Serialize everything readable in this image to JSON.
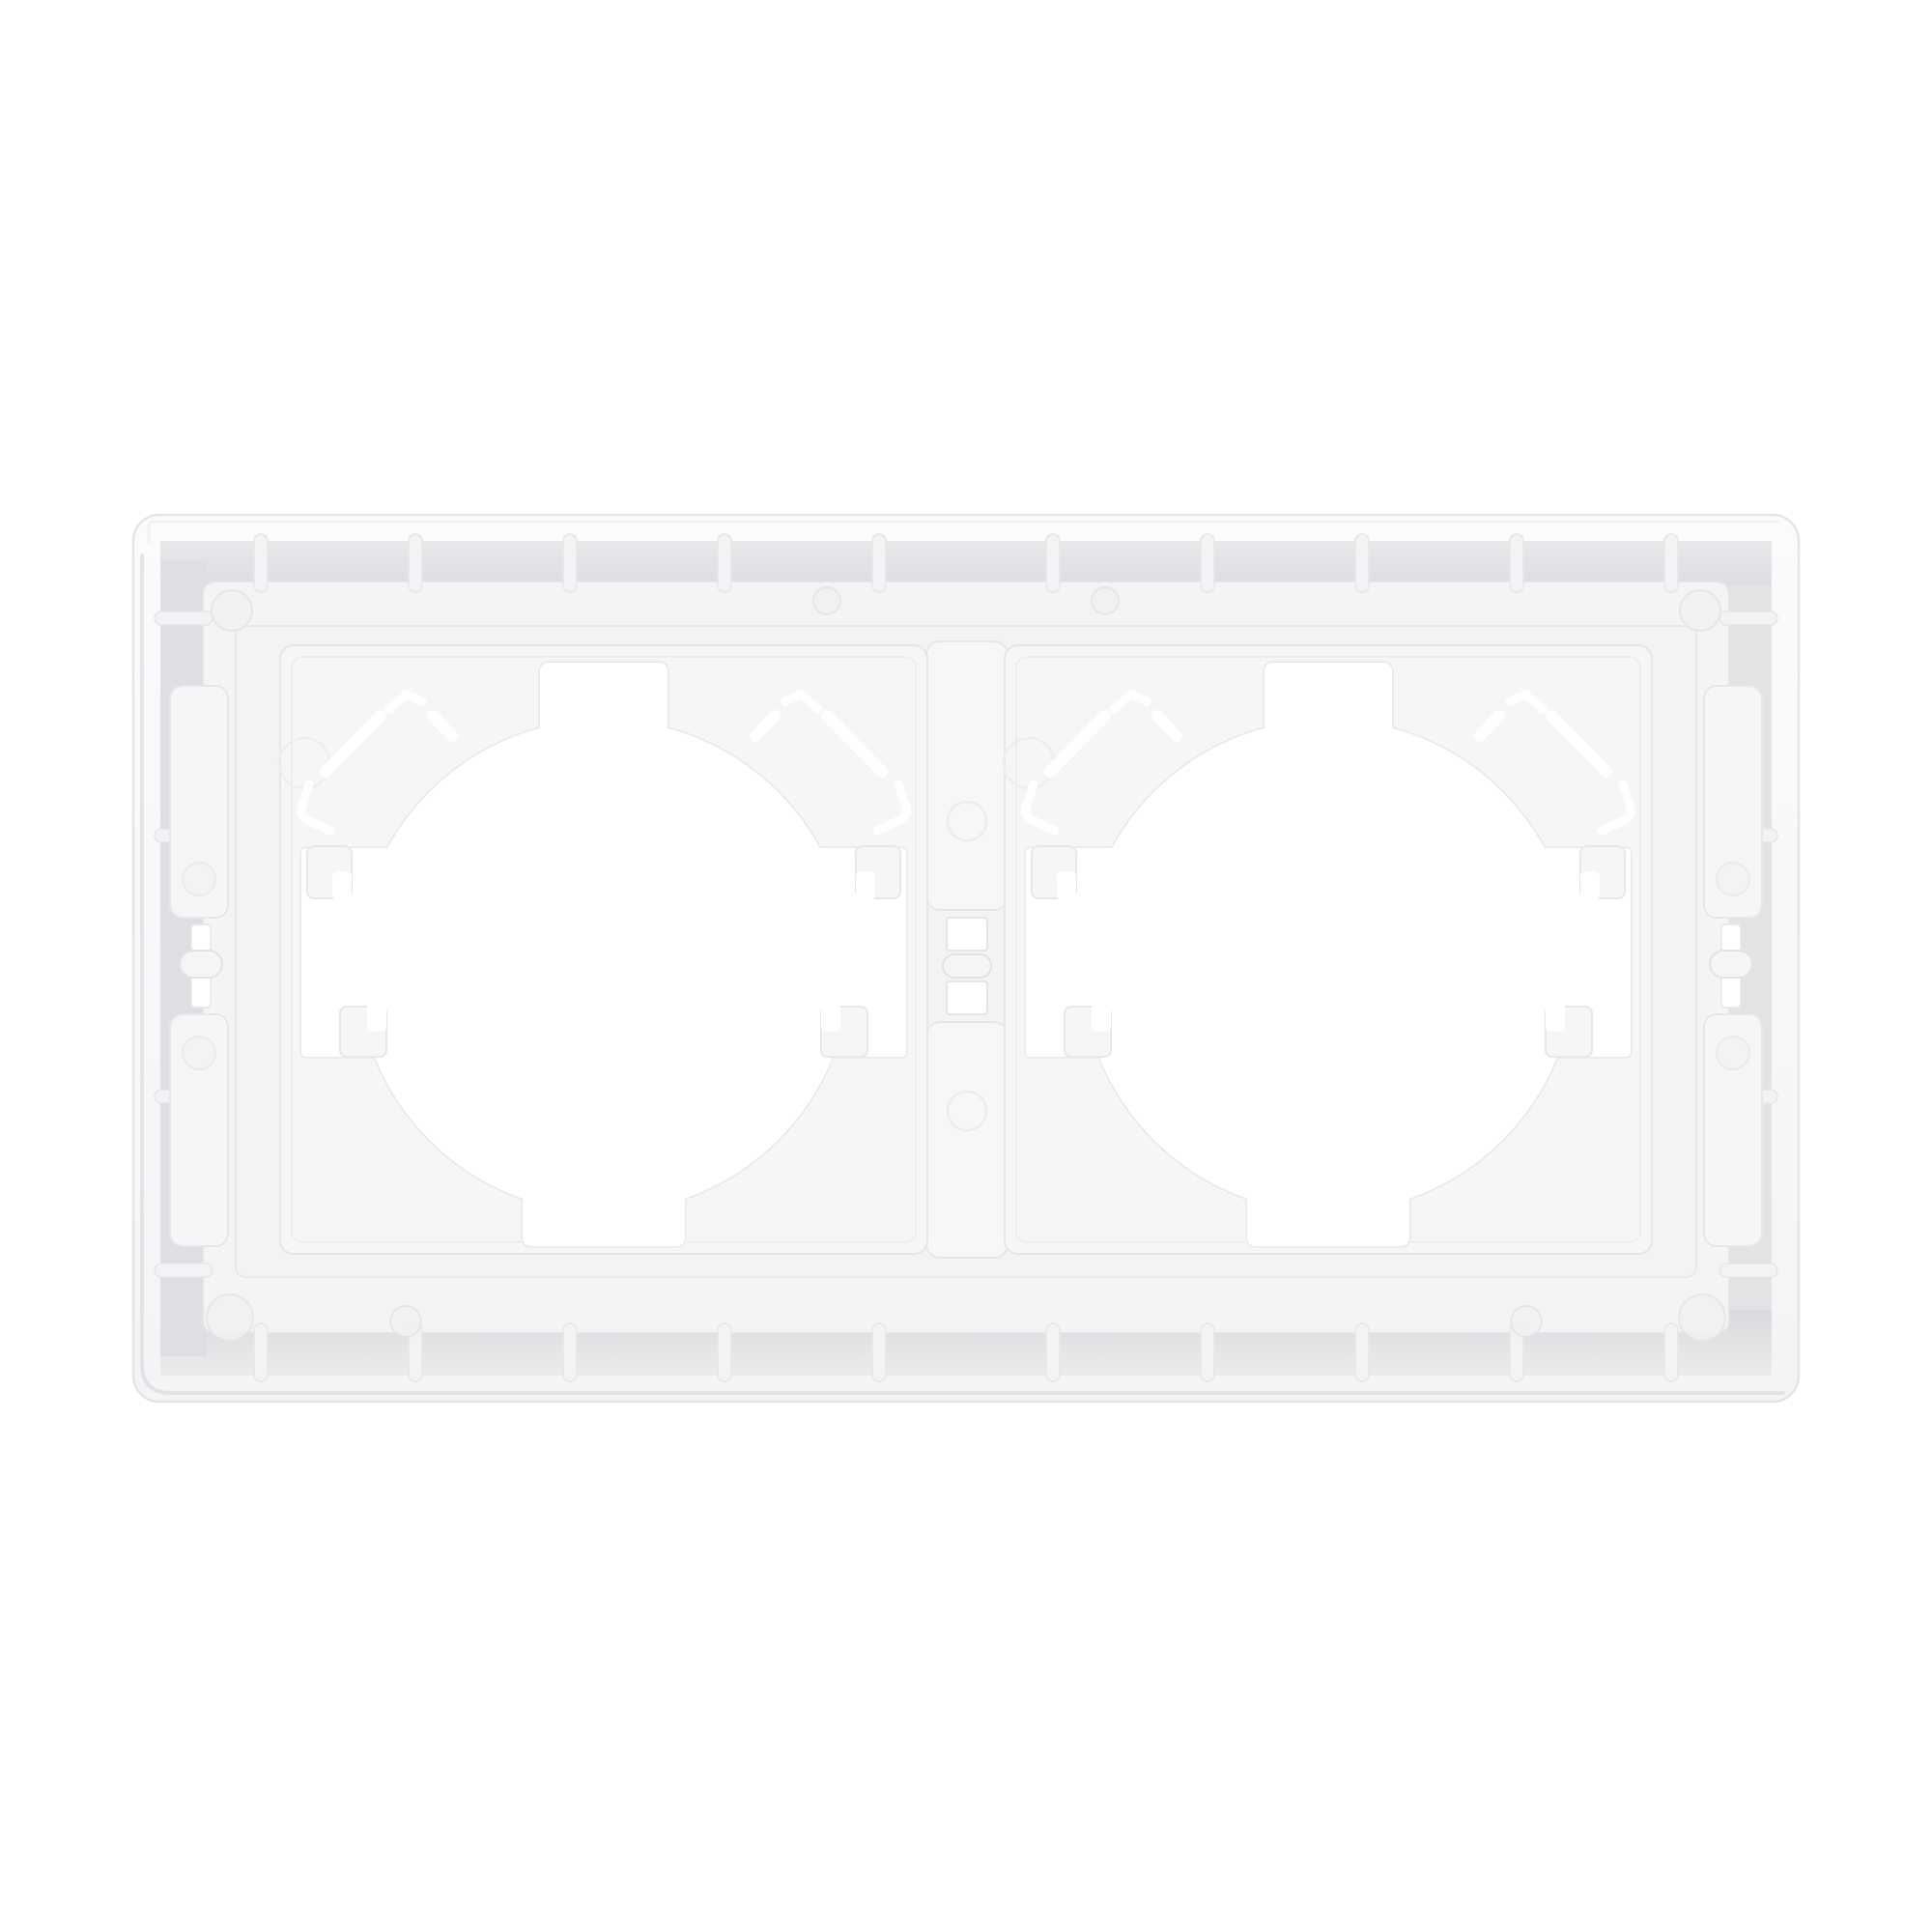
{
  "photo": {
    "alt": "Rear view of a white plastic two-gang wall switch and socket surround frame photographed flat on a plain white background",
    "object": "2-gang wall plate frame, back side",
    "gangs": 2,
    "view": "rear",
    "colors": {
      "background": "#ffffff",
      "plastic_base": "#f4f5f6",
      "plastic_raised": "#f6f7f8",
      "recess_channel": "#e2e3e5",
      "edge_line": "#e6e7e9",
      "deep_shadow": "#d9dadd",
      "cutout": "#ffffff"
    },
    "features": [
      "outer shell with rounded corners",
      "perimeter recess channel with mold ribs",
      "two square module plates",
      "large circular cutout per module",
      "top corner locking tabs with slot cutouts",
      "locking feet with hook notches",
      "center bridge stem with latch holes and pin",
      "left and right latch bars with pins and bumps",
      "ejector pin marks"
    ]
  }
}
